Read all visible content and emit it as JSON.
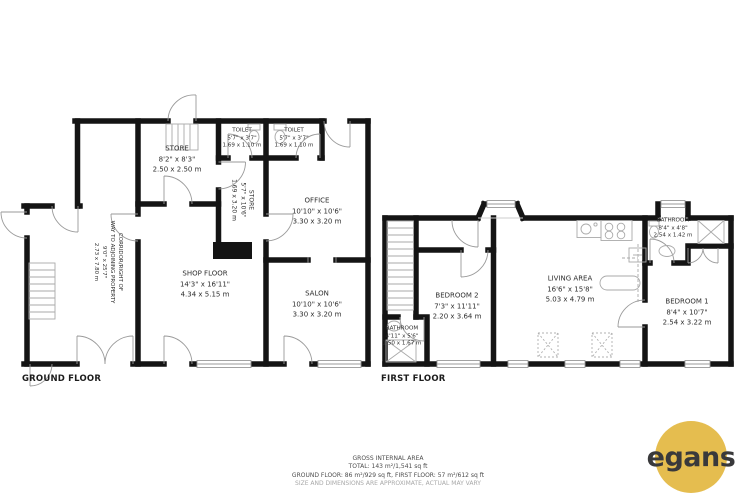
{
  "meta": {
    "wall_color": "#141414",
    "line_color": "#999999",
    "background": "#ffffff"
  },
  "ground_floor": {
    "label": "GROUND FLOOR",
    "rooms": [
      {
        "id": "store-1",
        "name": "STORE",
        "imperial": "8'2\" x 8'3\"",
        "metric": "2.50 x 2.50 m"
      },
      {
        "id": "toilet-1",
        "name": "TOILET",
        "imperial": "5'7\" x 3'7\"",
        "metric": "1.69 x 1.10 m"
      },
      {
        "id": "toilet-2",
        "name": "TOILET",
        "imperial": "5'7\" x 3'7\"",
        "metric": "1.69 x 1.10 m"
      },
      {
        "id": "store-2",
        "name": "STORE",
        "imperial": "5'7\" x 10'6\"",
        "metric": "1.69 x 3.20 m"
      },
      {
        "id": "office",
        "name": "OFFICE",
        "imperial": "10'10\" x 10'6\"",
        "metric": "3.30 x 3.20 m"
      },
      {
        "id": "shop-floor",
        "name": "SHOP FLOOR",
        "imperial": "14'3\" x 16'11\"",
        "metric": "4.34 x 5.15 m"
      },
      {
        "id": "salon",
        "name": "SALON",
        "imperial": "10'10\" x 10'6\"",
        "metric": "3.30 x 3.20 m"
      },
      {
        "id": "corridor",
        "name": "CORRIDOR/RIGHT OF",
        "name2": "WAY TO ADJOINING PROPERTY",
        "imperial": "9'0\" x 25'7\"",
        "metric": "2.73 x 7.80 m"
      }
    ]
  },
  "first_floor": {
    "label": "FIRST FLOOR",
    "rooms": [
      {
        "id": "bedroom-2",
        "name": "BEDROOM 2",
        "imperial": "7'3\" x 11'11\"",
        "metric": "2.20 x 3.64 m"
      },
      {
        "id": "bathroom-left",
        "name": "BATHROOM",
        "imperial": "4'11\" x 5'6\"",
        "metric": "1.50 x 1.67 m"
      },
      {
        "id": "living-area",
        "name": "LIVING AREA",
        "imperial": "16'6\" x 15'8\"",
        "metric": "5.03 x 4.79 m"
      },
      {
        "id": "bathroom-right",
        "name": "BATHROOM",
        "imperial": "8'4\" x 4'8\"",
        "metric": "2.54 x 1.42 m"
      },
      {
        "id": "bedroom-1",
        "name": "BEDROOM 1",
        "imperial": "8'4\" x 10'7\"",
        "metric": "2.54 x 3.22 m"
      }
    ]
  },
  "footer": {
    "line1": "GROSS INTERNAL AREA",
    "line2": "TOTAL: 143 m²/1,541 sq ft",
    "line3": "GROUND FLOOR: 86 m²/929 sq ft, FIRST FLOOR: 57 m²/612 sq ft",
    "disclaimer": "SIZE AND DIMENSIONS ARE APPROXIMATE, ACTUAL MAY VARY"
  },
  "logo": {
    "text": "egans",
    "circle_color": "#e5bd4f",
    "text_color": "#39393b"
  }
}
